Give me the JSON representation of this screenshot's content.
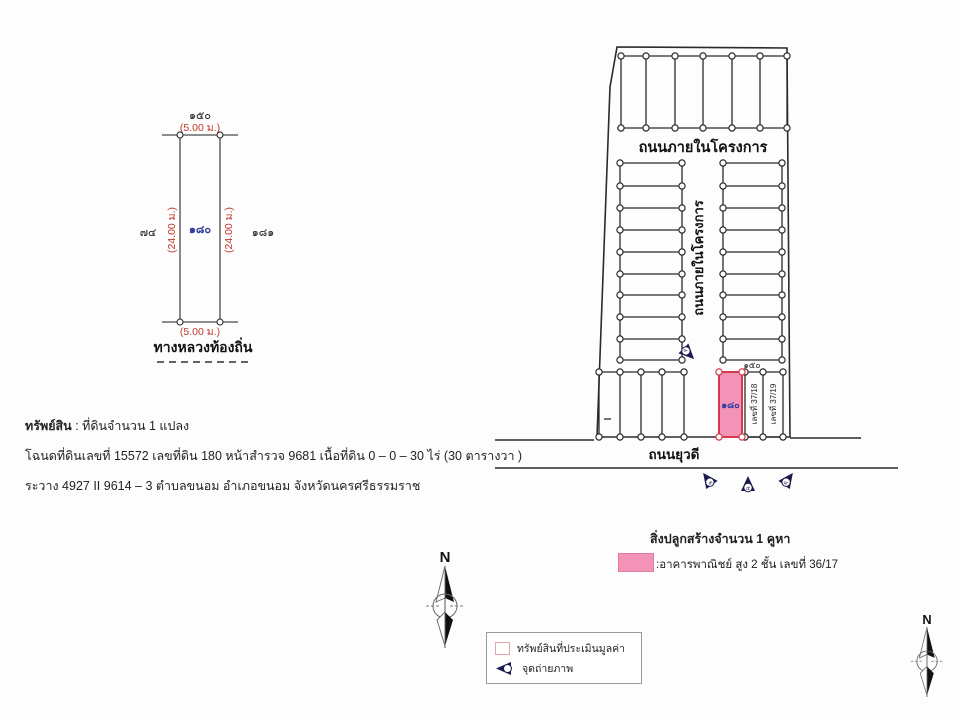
{
  "colors": {
    "line": "#2b2b2b",
    "dimension_red": "#c0392b",
    "parcel_blue": "#2f3d9e",
    "highlight_pink": "#f393b8",
    "highlight_outline_red": "#d5394c",
    "camera_navy": "#1b1b4f"
  },
  "left_diagram": {
    "top_neighbor_parcel": "๑๕๐",
    "frontage_dim_top": "(5.00 ม.)",
    "left_neighbor_parcel": "๗๔",
    "left_depth_dim": "(24.00 ม.)",
    "parcel_number": "๑๘๐",
    "right_depth_dim": "(24.00 ม.)",
    "right_neighbor_parcel": "๑๘๑",
    "frontage_dim_bottom": "(5.00 ม.)",
    "road_label": "ทางหลวงท้องถิ่น"
  },
  "property": {
    "heading": "ทรัพย์สิน",
    "heading_detail": ":  ที่ดินจำนวน 1 แปลง",
    "deed_line": "โฉนดที่ดินเลขที่ 15572 เลขที่ดิน 180 หน้าสำรวจ 9681 เนื้อที่ดิน 0 – 0 – 30 ไร่ (30 ตารางวา )",
    "sheet_line": "ระวาง  4927 II 9614 – 3 ตำบลขนอม   อำเภอขนอม  จังหวัดนครศรีธรรมราช"
  },
  "site_map": {
    "internal_road_label": "ถนนภายในโครงการ",
    "internal_road_vertical_label": "ถนนภายในโครงการ",
    "front_road_label": "ถนนยุวดี",
    "subject_parcel_number": "๑๘๐",
    "adjacent_parcel_number": "๑๕๐",
    "house_no_1": "เลขที่ 37/18",
    "house_no_2": "เลขที่ 37/19",
    "photo_point_mid": "๖",
    "photo_point_left": "๓",
    "photo_point_center": "๕",
    "photo_point_right": "๔"
  },
  "building": {
    "title": "สิ่งปลูกสร้างจำนวน 1 คูหา",
    "description": ":อาคารพาณิชย์ สูง 2 ชั้น เลขที่ 36/17"
  },
  "legend": {
    "appraised_property_label": "ทรัพย์สินที่ประเมินมูลค่า",
    "photo_point_label": "จุดถ่ายภาพ"
  },
  "compass": {
    "north": "N"
  }
}
